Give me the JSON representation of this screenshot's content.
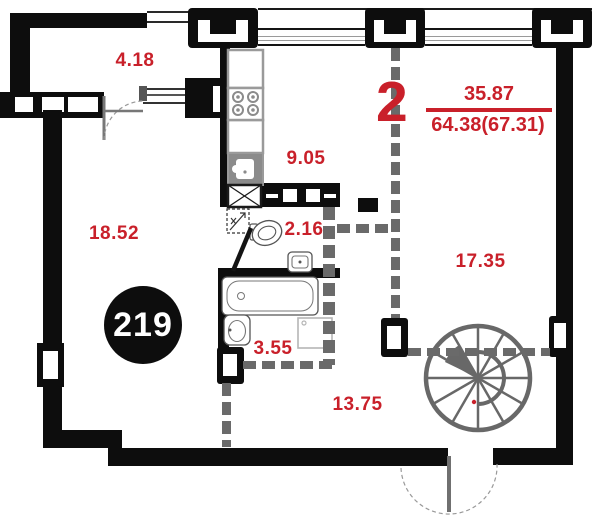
{
  "floor_plan": {
    "unit_badge": "219",
    "room_count": "2",
    "area_fraction": {
      "living_total": "35.87",
      "overall_total": "64.38(67.31)"
    },
    "room_areas": {
      "balcony": "4.18",
      "living_room": "18.52",
      "kitchen": "9.05",
      "wc": "2.16",
      "bathroom": "3.55",
      "hallway": "13.75",
      "bedroom": "17.35"
    },
    "colors": {
      "label_red": "#c9202a",
      "wall_black": "#0d0d0d",
      "partition_gray": "#6a6a6a",
      "fixture_gray": "#8b8b8b"
    }
  }
}
